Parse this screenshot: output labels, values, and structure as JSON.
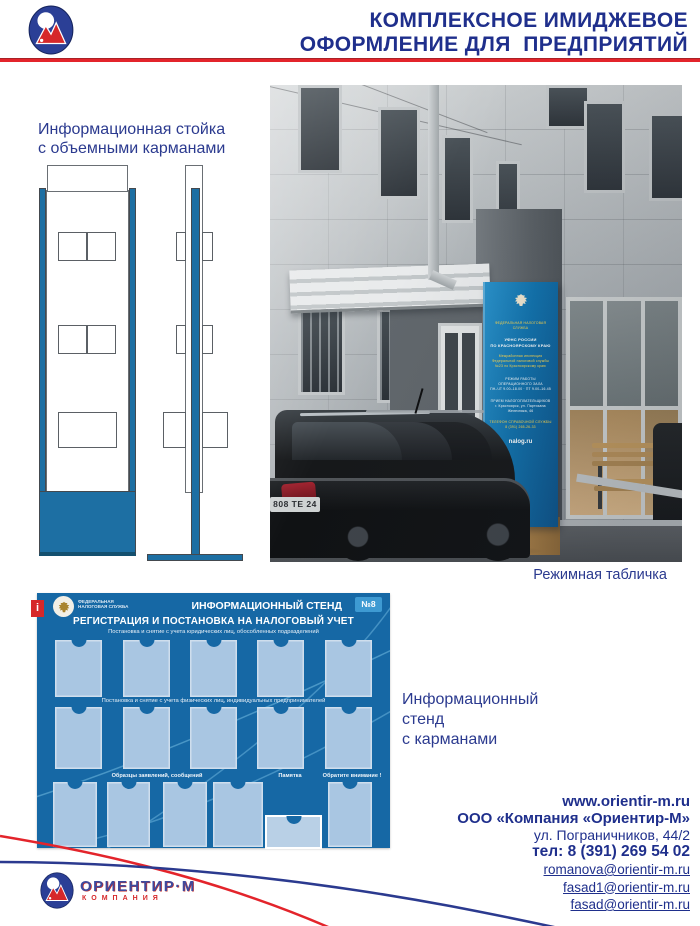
{
  "header": {
    "title1": "КОМПЛЕКСНОЕ ИМИДЖЕВОЕ",
    "title2": "ОФОРМЛЕНИЕ ДЛЯ  ПРЕДПРИЯТИЙ"
  },
  "stand_drawing": {
    "caption1": "Информационная стойка",
    "caption2": "с объемными карманами"
  },
  "photo": {
    "caption": "Режимная табличка",
    "license_plate": "808 ТЕ 24",
    "pylon": {
      "lines": [
        "ФЕДЕРАЛЬНАЯ НАЛОГОВАЯ СЛУЖБА",
        "УФНС РОССИИ",
        "ПО КРАСНОЯРСКОМУ КРАЮ",
        "Межрайонная инспекция Федеральной налоговой службы №23 по Красноярскому краю",
        "РЕЖИМ РАБОТЫ ОПЕРАЦИОННОГО ЗАЛА",
        "ПН–ЧТ 9.00–18.00 · ПТ 9.00–16.45",
        "ПРИЕМ НАЛОГОПЛАТЕЛЬЩИКОВ",
        "г. Красноярск, ул. Партизана Железняка, 46",
        "ТЕЛЕФОН СПРАВОЧНОЙ СЛУЖБЫ 8 (391) 265-26-33",
        "nalog.ru"
      ]
    }
  },
  "board": {
    "info_letter": "i",
    "agency1": "ФЕДЕРАЛЬНАЯ",
    "agency2": "НАЛОГОВАЯ СЛУЖБА",
    "type": "ИНФОРМАЦИОННЫЙ СТЕНД",
    "number": "№8",
    "title": "РЕГИСТРАЦИЯ И ПОСТАНОВКА НА НАЛОГОВЫЙ УЧЕТ",
    "section1": "Постановка и снятие  с учета юридических лиц, обособленных подразделений",
    "section2": "Постановка и снятие  с учета физических лиц, индивидуальных предпринимателей",
    "label_samples": "Образцы заявлений, сообщений",
    "label_memo": "Памятка",
    "label_attention": "Обратите внимание !"
  },
  "board_caption": {
    "line1": "Информационный",
    "line2": "стенд",
    "line3": "с карманами"
  },
  "contacts": {
    "website": "www.orientir-m.ru",
    "company": "ООО «Компания «Ориентир-М»",
    "address": "ул. Пограничников, 44/2",
    "phone": "тел: 8 (391) 269 54 02",
    "emails": [
      "romanova@orientir-m.ru",
      "fasad1@orientir-m.ru",
      "fasad@orientir-m.ru"
    ]
  },
  "footer_logo": {
    "name": "ОРИЕНТИР·М",
    "subtitle": "КОМПАНИЯ"
  },
  "colors": {
    "brand-blue": "#1f2f8c",
    "link-blue": "#2b3a8f",
    "accent-red": "#e3242b",
    "draw-blue": "#1d6fa3",
    "board-blue": "#1668a5",
    "pocket-blue": "#a9c6e2",
    "badge-blue": "#3e9ad2",
    "logo-red": "#d6282a"
  }
}
